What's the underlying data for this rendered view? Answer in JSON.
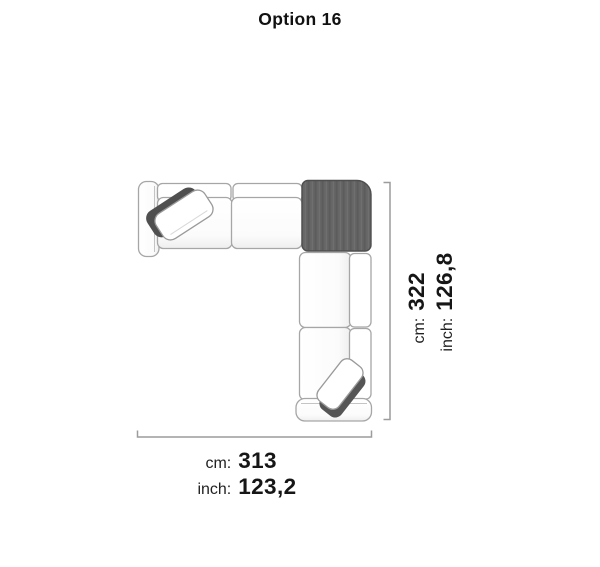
{
  "title": "Option 16",
  "sofa_diagram": {
    "label": "L-shaped sectional sofa, top view",
    "highlighted_module": "corner module (top right)",
    "highlight_color": "#666666",
    "outline_color": "#a6a6a6",
    "dimension_line_color": "#9c9c9c"
  },
  "dimension_width": {
    "cm_label": "cm:",
    "cm_value": "313",
    "inch_label": "inch:",
    "inch_value": "123,2"
  },
  "dimension_height": {
    "cm_label": "cm:",
    "cm_value": "322",
    "inch_label": "inch:",
    "inch_value": "126,8"
  }
}
